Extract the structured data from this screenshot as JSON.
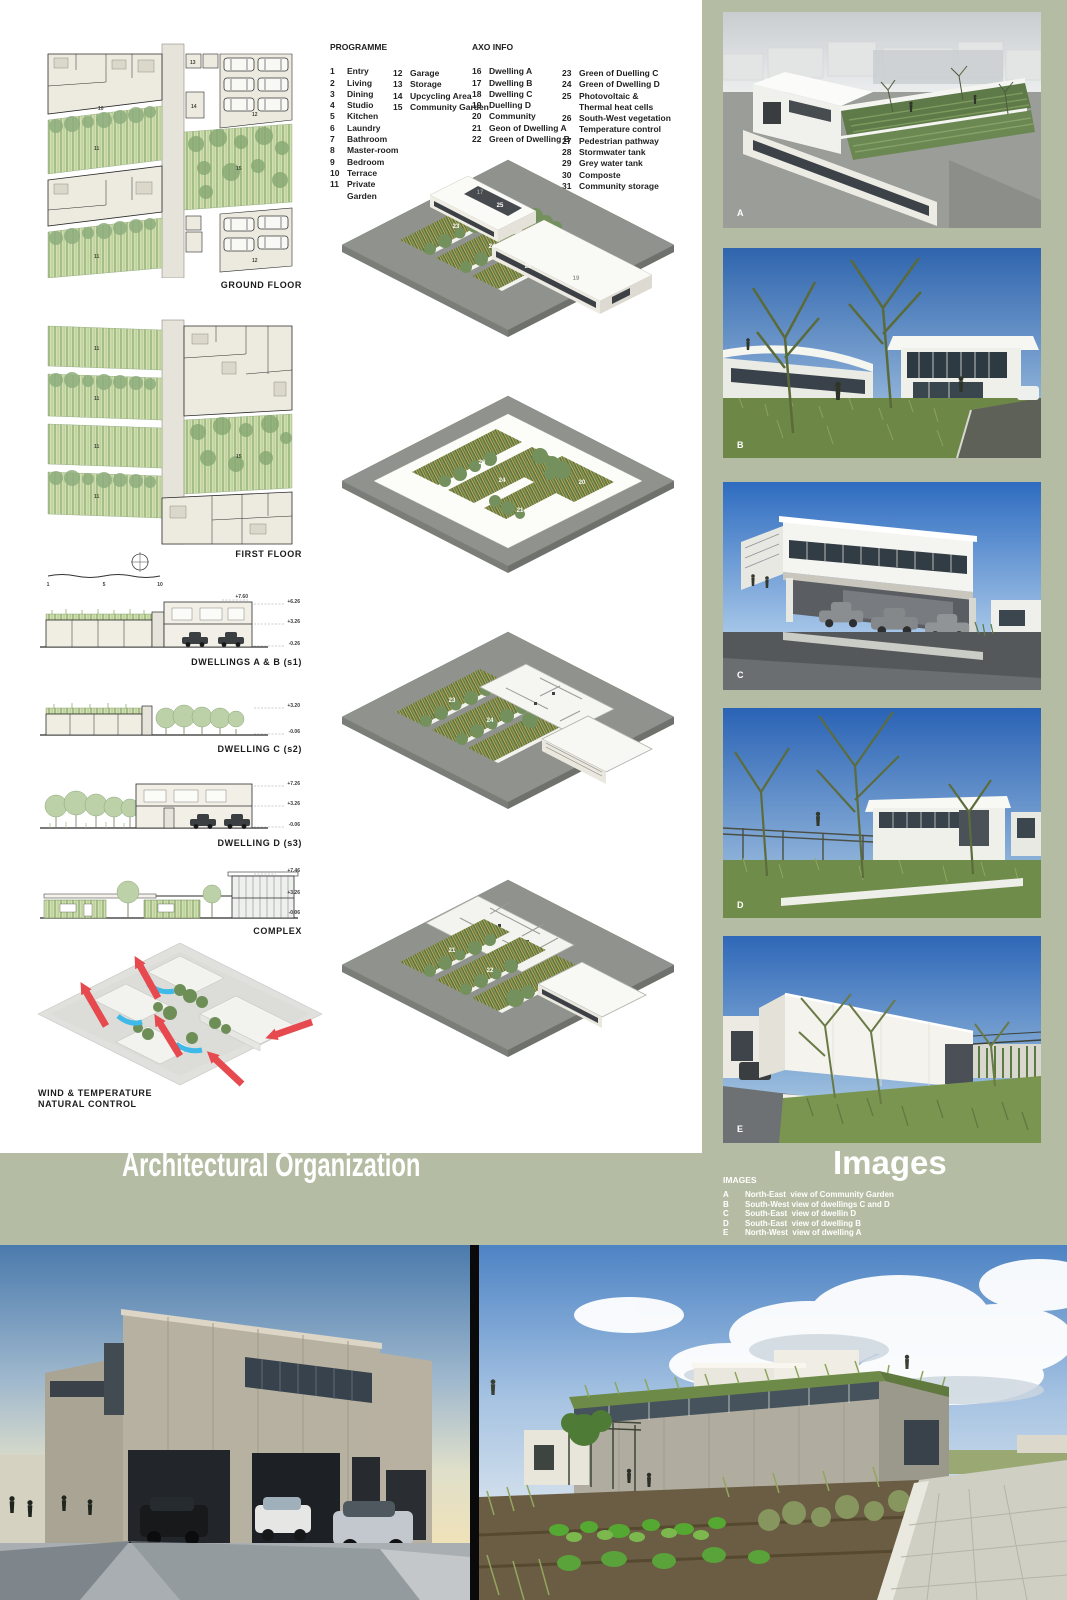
{
  "board": {
    "left_title": "Architectural Organization"
  },
  "colors": {
    "sage": "#b4bda3",
    "wind_red": "#e64a4e",
    "wind_blue": "#3fb9e8",
    "panel_white": "#ffffff"
  },
  "programme": {
    "heading": "PROGRAMME",
    "col1": [
      {
        "n": "1",
        "t": "Entry"
      },
      {
        "n": "2",
        "t": "Living"
      },
      {
        "n": "3",
        "t": "Dining"
      },
      {
        "n": "4",
        "t": "Studio"
      },
      {
        "n": "5",
        "t": "Kitchen"
      },
      {
        "n": "6",
        "t": "Laundry"
      },
      {
        "n": "7",
        "t": "Bathroom"
      },
      {
        "n": "8",
        "t": "Master-room"
      },
      {
        "n": "9",
        "t": "Bedroom"
      },
      {
        "n": "10",
        "t": "Terrace"
      },
      {
        "n": "11",
        "t": "Private\nGarden"
      }
    ],
    "col2": [
      {
        "n": "12",
        "t": "Garage"
      },
      {
        "n": "13",
        "t": "Storage"
      },
      {
        "n": "14",
        "t": "Upcycling Area"
      },
      {
        "n": "15",
        "t": "Community Garden"
      }
    ]
  },
  "axo_info": {
    "heading": "AXO INFO",
    "col1": [
      {
        "n": "16",
        "t": "Dwelling A"
      },
      {
        "n": "17",
        "t": "Dwelling B"
      },
      {
        "n": "18",
        "t": "Dwelling C"
      },
      {
        "n": "19",
        "t": "Duelling D"
      },
      {
        "n": "20",
        "t": "Community"
      },
      {
        "n": "21",
        "t": "Geon of Dwelling A"
      },
      {
        "n": "22",
        "t": "Green of Dwelling B"
      }
    ],
    "col2": [
      {
        "n": "23",
        "t": "Green of Duelling C"
      },
      {
        "n": "24",
        "t": "Green of Dwelling D"
      },
      {
        "n": "25",
        "t": "Photovoltaic &\nThermal heat cells"
      },
      {
        "n": "26",
        "t": "South-West vegetation\nTemperature control"
      },
      {
        "n": "27",
        "t": "Pedestrian pathway"
      },
      {
        "n": "28",
        "t": "Stormwater tank"
      },
      {
        "n": "29",
        "t": "Grey water tank"
      },
      {
        "n": "30",
        "t": "Composte"
      },
      {
        "n": "31",
        "t": "Community storage"
      }
    ]
  },
  "plans": {
    "ground_label": "GROUND FLOOR",
    "first_label": "FIRST FLOOR",
    "numbers": {
      "terrace": "10",
      "private_garden": "11",
      "garage": "12",
      "storage": "13",
      "upcycling": "14",
      "community_garden": "15"
    }
  },
  "scale": {
    "t1": "1",
    "t2": "5",
    "t3": "10"
  },
  "sections": {
    "s1": {
      "label": "DWELLINGS A & B (s1)",
      "top": "+7.60",
      "l1": "+6.26",
      "l2": "+3.26",
      "l3": "-0.26"
    },
    "s2": {
      "label": "DWELLING C (s2)",
      "l1": "+3.20",
      "l2": "-0.06"
    },
    "s3": {
      "label": "DWELLING D (s3)",
      "l1": "+7.26",
      "l2": "+3.26",
      "l3": "-0.06"
    },
    "complex": {
      "label": "COMPLEX",
      "l1": "+7.46",
      "l2": "+3.26",
      "l3": "-0.06"
    }
  },
  "wind": {
    "line1": "WIND & TEMPERATURE",
    "line2": "NATURAL CONTROL"
  },
  "axos": {
    "a1": {
      "n1": "17",
      "n2": "25",
      "n3": "19",
      "n4": "23",
      "n5": "24",
      "n6": "21"
    },
    "a2": {
      "n1": "23",
      "n2": "26",
      "n3": "24",
      "n4": "20",
      "n5": "21"
    },
    "a3": {
      "n1": "23",
      "n2": "24"
    },
    "a4": {
      "n1": "21",
      "n2": "22"
    }
  },
  "images_panel": {
    "title": "Images",
    "heading": "IMAGES",
    "items": [
      {
        "key": "A",
        "caption": "North-East  view of Community Garden"
      },
      {
        "key": "B",
        "caption": "South-West view of dwellings C and D"
      },
      {
        "key": "C",
        "caption": "South-East  view of dwellin D"
      },
      {
        "key": "D",
        "caption": "South-East  view of dwelling B"
      },
      {
        "key": "E",
        "caption": "North-West  view of dwelling A"
      }
    ],
    "labels": {
      "a": "A",
      "b": "B",
      "c": "C",
      "d": "D",
      "e": "E"
    }
  }
}
